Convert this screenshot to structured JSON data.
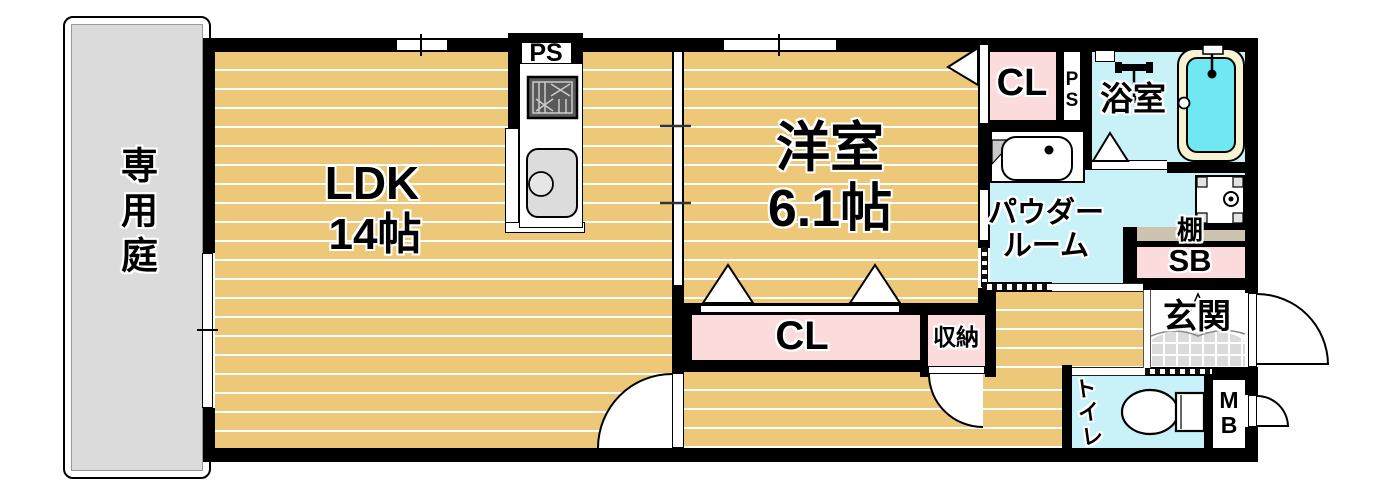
{
  "plan_title": "1LDK floor plan",
  "colors": {
    "floor_tan": "#ECC878",
    "closet_pink": "#FBDBDB",
    "water_cyan": "#C9F2F8",
    "tub_inner": "#6FE8F3",
    "tub_rim": "#F6F2D2",
    "shelf_beige": "#CDC3B1",
    "tile_gray": "#DBDBDB",
    "wall_black": "#000000"
  },
  "rooms": {
    "garden": {
      "label": "専用庭"
    },
    "ldk": {
      "label": "LDK",
      "size": "14帖"
    },
    "western_room": {
      "label": "洋室",
      "size": "6.1帖"
    },
    "closet_upper": {
      "label": "CL"
    },
    "closet_lower": {
      "label": "CL"
    },
    "storage": {
      "label": "収納"
    },
    "bathroom": {
      "label": "浴室"
    },
    "powder_room": {
      "label_line1": "パウダー",
      "label_line2": "ルーム"
    },
    "toilet": {
      "label": "トイレ"
    },
    "entrance": {
      "label": "玄関"
    },
    "shelf": {
      "label": "棚"
    },
    "shoe_box": {
      "label": "SB"
    },
    "meter_box": {
      "label": "MB"
    },
    "pipe_space_kitchen": {
      "label": "PS"
    },
    "pipe_space_bath": {
      "label": "PS"
    }
  }
}
